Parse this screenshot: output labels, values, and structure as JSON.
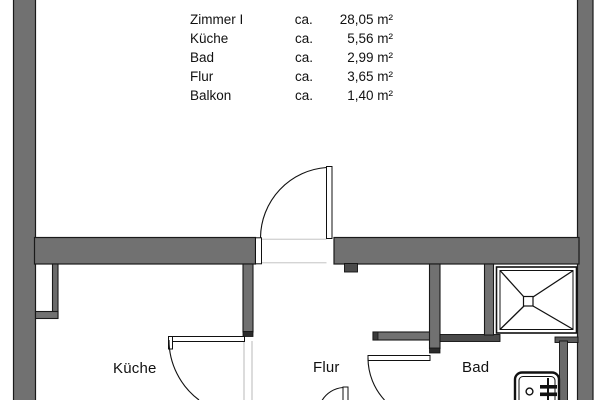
{
  "legend": {
    "rows": [
      {
        "name": "Zimmer I",
        "ca": "ca.",
        "value": "28,05 m²"
      },
      {
        "name": "Küche",
        "ca": "ca.",
        "value": "5,56 m²"
      },
      {
        "name": "Bad",
        "ca": "ca.",
        "value": "2,99 m²"
      },
      {
        "name": "Flur",
        "ca": "ca.",
        "value": "3,65 m²"
      },
      {
        "name": "Balkon",
        "ca": "ca.",
        "value": "1,40 m²"
      }
    ]
  },
  "rooms": {
    "kueche": {
      "label": "Küche"
    },
    "flur": {
      "label": "Flur"
    },
    "bad": {
      "label": "Bad"
    }
  },
  "colors": {
    "wall": "#717171",
    "wall_cap": "#2b2b2b",
    "outline": "#1a1a1a",
    "hairline": "#b3b3b3",
    "background": "#ffffff"
  }
}
